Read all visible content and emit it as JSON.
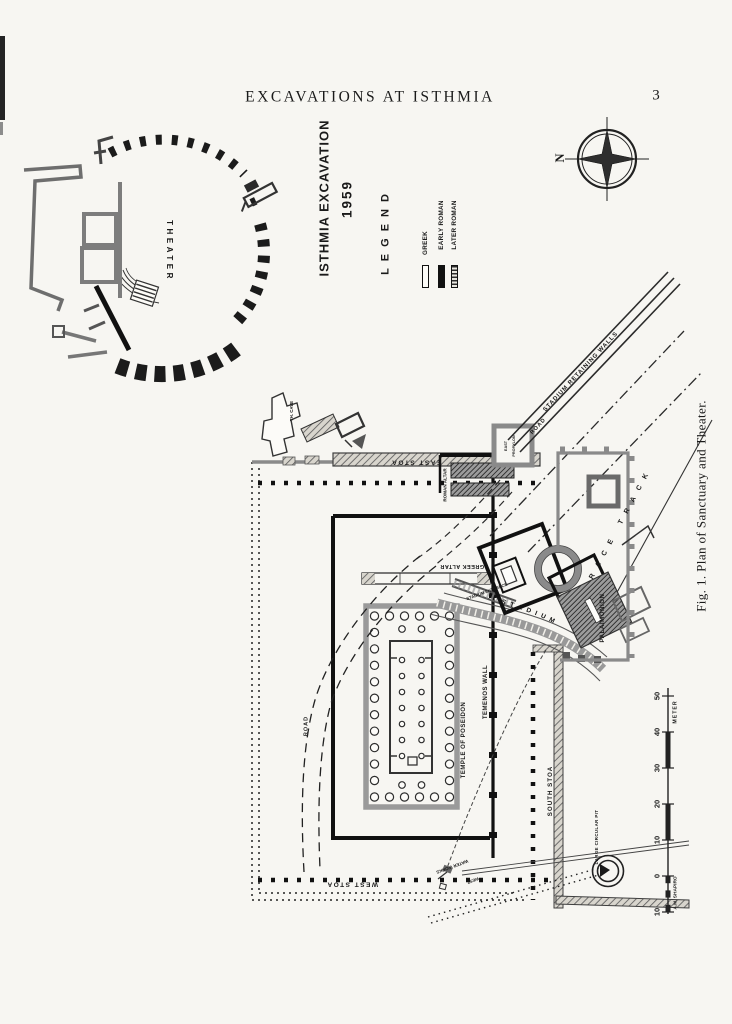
{
  "page": {
    "header": "EXCAVATIONS AT ISTHMIA",
    "page_number": "3",
    "caption": "Fig. 1.  Plan of Sanctuary and Theater."
  },
  "plan": {
    "title_line1": "ISTHMIA EXCAVATION",
    "title_line2": "1959",
    "legend": {
      "heading": "LEGEND",
      "items": [
        {
          "label": "GREEK",
          "style": "outline"
        },
        {
          "label": "EARLY ROMAN",
          "style": "solid"
        },
        {
          "label": "LATER ROMAN",
          "style": "hatched"
        }
      ]
    },
    "compass_n": "N",
    "scale": {
      "ticks": [
        "50",
        "40",
        "30",
        "20",
        "10",
        "0",
        "10"
      ],
      "unit": "METER",
      "credit": "A.M. SHAPIRO"
    },
    "labels": {
      "theater": "THEATER",
      "theater_cave": "TH. CAVE",
      "east_stoa": "EAST STOA",
      "west_stoa": "WEST STOA",
      "south_stoa": "SOUTH STOA",
      "east_propylon_line1": "EAST",
      "east_propylon_line2": "PROPYLON",
      "roman_altar": "ROMAN ALTAR",
      "greek_altar": "GREEK ALTAR",
      "temple_of_poseidon": "TEMPLE OF POSEIDON",
      "temenos_wall": "TEMENOS WALL",
      "road_northeast": "ROAD",
      "road_west": "ROAD",
      "stadium_retaining_walls": "STADIUM RETAINING WALLS",
      "stadium_entrance": "STADIUM ENTRANCE",
      "stadium": "STADIUM",
      "race_track": "RACE TRACK",
      "palaimonion": "PALAIMONION",
      "water_works": "WATER WORKS",
      "west": "WEST",
      "large_circular_pit": "LARGE CIRCULAR PIT"
    },
    "colors": {
      "ink": "#1a1a1a",
      "paper": "#f7f6f2",
      "wall_gray": "#8a8a8a"
    }
  }
}
